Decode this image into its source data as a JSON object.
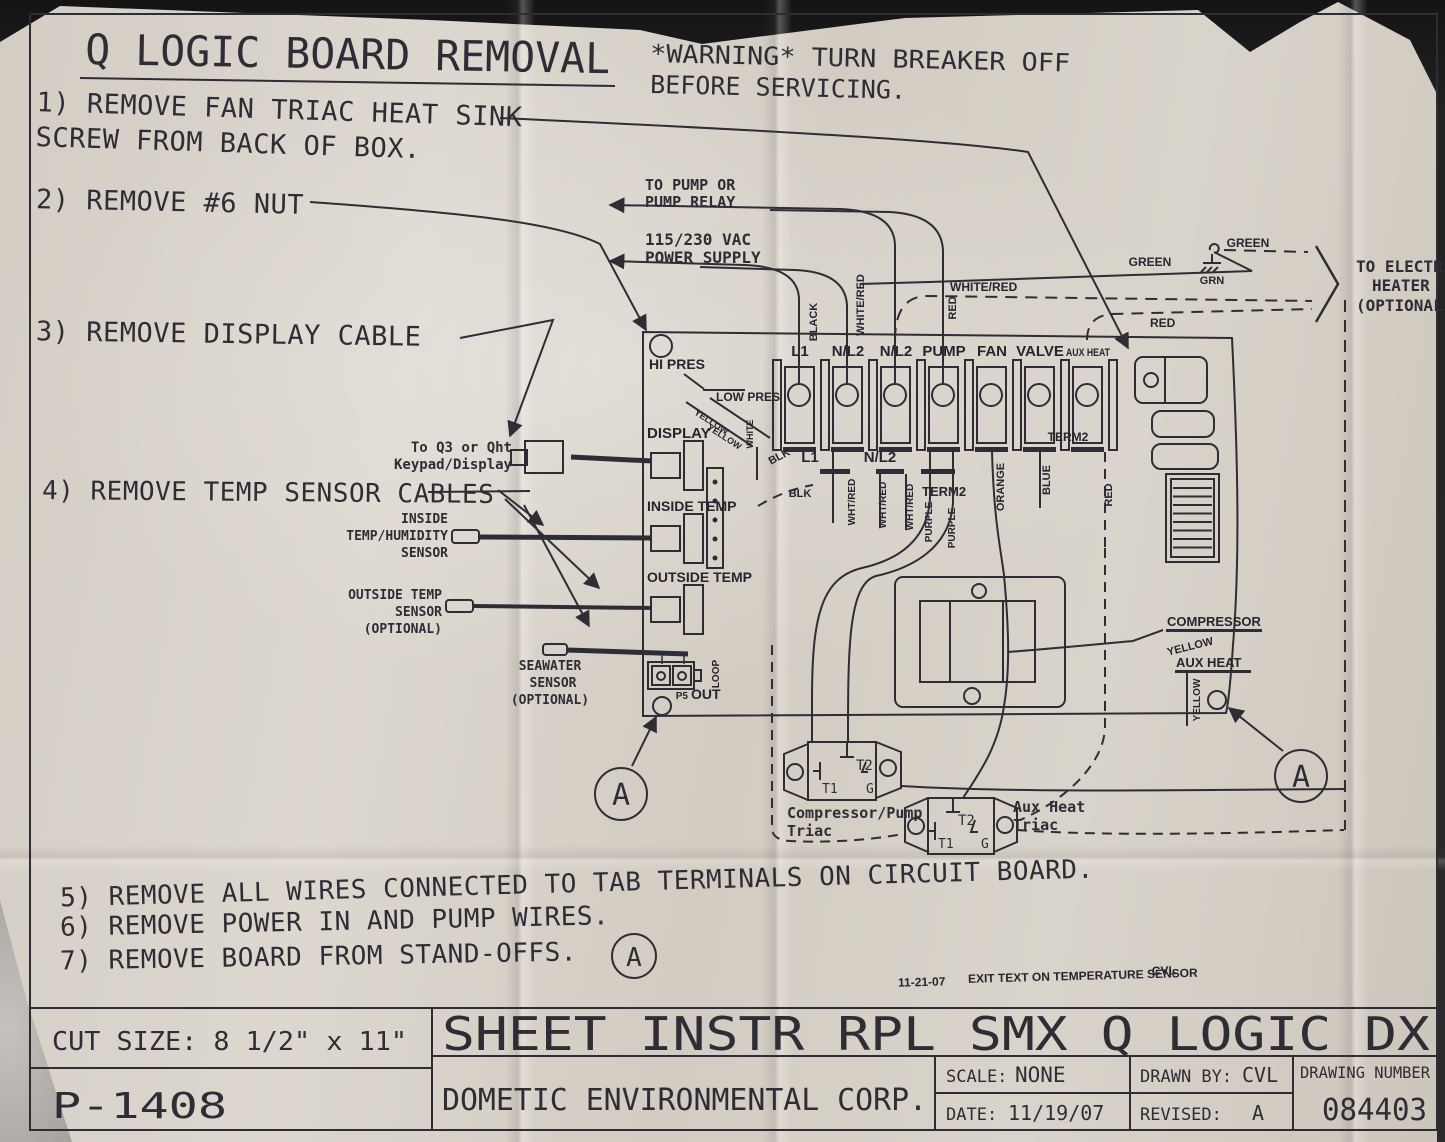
{
  "photo": {
    "paper_color": "#d8d2c8",
    "ink_color": "#2e2d36",
    "background_color": "#232325"
  },
  "title": "Q LOGIC BOARD REMOVAL",
  "warning": [
    "*WARNING* TURN BREAKER OFF",
    "BEFORE SERVICING."
  ],
  "steps": [
    "1) REMOVE FAN TRIAC HEAT SINK SCREW FROM BACK OF BOX.",
    "2) REMOVE #6 NUT",
    "3) REMOVE DISPLAY CABLE",
    "4) REMOVE TEMP SENSOR CABLES",
    "5) REMOVE ALL WIRES CONNECTED TO TAB TERMINALS ON CIRCUIT BOARD.",
    "6) REMOVE POWER IN AND PUMP WIRES.",
    "7) REMOVE BOARD FROM STAND-OFFS."
  ],
  "callout_a": "A",
  "connections": {
    "to_pump": [
      "TO PUMP OR",
      "PUMP RELAY"
    ],
    "power_supply": [
      "115/230 VAC",
      "POWER SUPPLY"
    ],
    "electric_heater": [
      "TO ELECTRIC",
      "HEATER",
      "(OPTIONAL)"
    ],
    "keypad": [
      "To Q3 or Qht",
      "Keypad/Display"
    ],
    "inside_sensor": [
      "INSIDE",
      "TEMP/HUMIDITY",
      "SENSOR"
    ],
    "outside_sensor": [
      "OUTSIDE TEMP",
      "SENSOR",
      "(OPTIONAL)"
    ],
    "seawater_sensor": [
      "SEAWATER",
      "SENSOR",
      "(OPTIONAL)"
    ]
  },
  "wire_labels": {
    "black": "BLACK",
    "white_red": "WHITE/RED",
    "red": "RED",
    "green": "GREEN",
    "grn": "GRN",
    "blk": "BLK",
    "wht_red": "WHT/RED",
    "purple": "PURPLE",
    "orange": "ORANGE",
    "blue": "BLUE",
    "yellow": "YELLOW",
    "white": "WHITE"
  },
  "board": {
    "hi_pres": "HI PRES",
    "low_pres": "LOW PRES",
    "display": "DISPLAY",
    "inside_temp": "INSIDE TEMP",
    "outside_temp": "OUTSIDE TEMP",
    "p5": "P5",
    "out": "OUT",
    "loop": "LOOP",
    "terminals": [
      "L1",
      "N/L2",
      "N/L2",
      "PUMP",
      "FAN",
      "VALVE",
      "AUX HEAT"
    ],
    "term2": "TERM2",
    "tab_l1": "L1",
    "tab_nl2": "N/L2",
    "compressor": "COMPRESSOR",
    "aux_heat": "AUX HEAT"
  },
  "triacs": {
    "t1": "T1",
    "t2": "T2",
    "g": "G",
    "compressor_label": [
      "Compressor/Pump",
      "Triac"
    ],
    "aux_label": [
      "Aux Heat",
      "Triac"
    ]
  },
  "note": {
    "date": "11-21-07",
    "text": "EXIT TEXT ON TEMPERATURE SENSOR",
    "initials": "CVL"
  },
  "titleblock": {
    "cut_size": "CUT SIZE: 8 1/2\" x 11\"",
    "part_number": "P-1408",
    "sheet_title": "SHEET INSTR RPL SMX Q LOGIC DX",
    "company": "DOMETIC ENVIRONMENTAL CORP.",
    "scale_label": "SCALE:",
    "scale": "NONE",
    "date_label": "DATE:",
    "date": "11/19/07",
    "drawn_label": "DRAWN BY:",
    "drawn": "CVL",
    "revised_label": "REVISED:",
    "revised": "A",
    "drawing_number_label": "DRAWING NUMBER",
    "drawing_number": "084403"
  }
}
